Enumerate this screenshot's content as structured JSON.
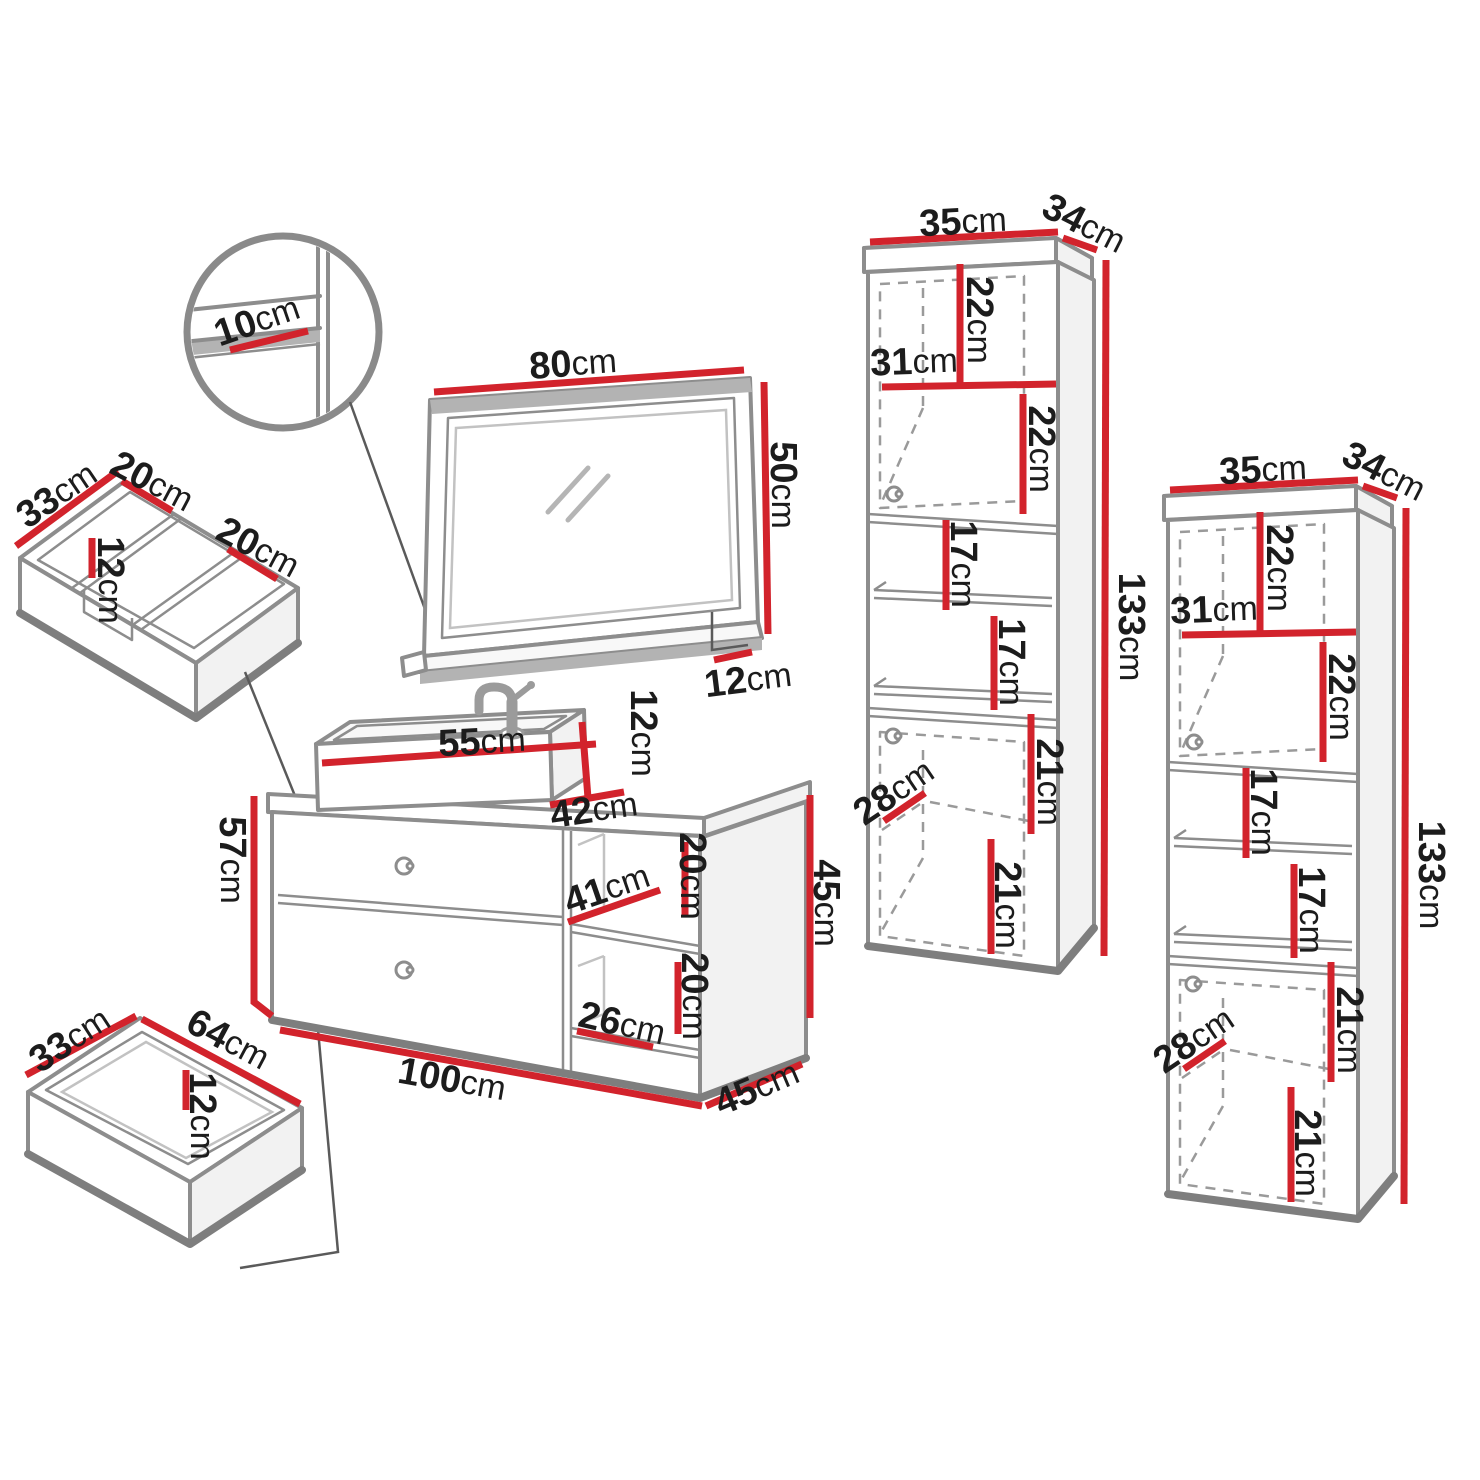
{
  "colors": {
    "red": "#d2232c",
    "gray": "#8d8d8d",
    "edge": "#7e7e7e",
    "dash": "#9a9a9a",
    "ink": "#1c1c1c",
    "bg": "#ffffff"
  },
  "detail_circle": {
    "shelf_depth": {
      "v": "10",
      "u": "cm"
    }
  },
  "mirror": {
    "width": {
      "v": "80",
      "u": "cm"
    },
    "height": {
      "v": "50",
      "u": "cm"
    },
    "shelf_depth": {
      "v": "12",
      "u": "cm"
    }
  },
  "organizer_insert": {
    "depth": {
      "v": "33",
      "u": "cm"
    },
    "left_width": {
      "v": "20",
      "u": "cm"
    },
    "height": {
      "v": "12",
      "u": "cm"
    },
    "right_width": {
      "v": "20",
      "u": "cm"
    }
  },
  "bottom_drawer": {
    "depth": {
      "v": "33",
      "u": "cm"
    },
    "width": {
      "v": "64",
      "u": "cm"
    },
    "height": {
      "v": "12",
      "u": "cm"
    }
  },
  "sink": {
    "width": {
      "v": "55",
      "u": "cm"
    },
    "height": {
      "v": "12",
      "u": "cm"
    },
    "depth": {
      "v": "42",
      "u": "cm"
    }
  },
  "vanity": {
    "height_left": {
      "v": "57",
      "u": "cm"
    },
    "width": {
      "v": "100",
      "u": "cm"
    },
    "depth": {
      "v": "45",
      "u": "cm"
    },
    "height_right": {
      "v": "45",
      "u": "cm"
    },
    "niche_top_height": {
      "v": "20",
      "u": "cm"
    },
    "niche_width": {
      "v": "41",
      "u": "cm"
    },
    "niche_bottom_height": {
      "v": "20",
      "u": "cm"
    },
    "niche_bottom_width": {
      "v": "26",
      "u": "cm"
    }
  },
  "cabinet_1": {
    "width": {
      "v": "35",
      "u": "cm"
    },
    "depth": {
      "v": "34",
      "u": "cm"
    },
    "height": {
      "v": "133",
      "u": "cm"
    },
    "top_section_height": {
      "v": "22",
      "u": "cm"
    },
    "shelf_width": {
      "v": "31",
      "u": "cm"
    },
    "second_section_height": {
      "v": "22",
      "u": "cm"
    },
    "mid_shelf_1_height": {
      "v": "17",
      "u": "cm"
    },
    "mid_shelf_2_height": {
      "v": "17",
      "u": "cm"
    },
    "lower_top_height": {
      "v": "21",
      "u": "cm"
    },
    "door_depth": {
      "v": "28",
      "u": "cm"
    },
    "lower_bottom_height": {
      "v": "21",
      "u": "cm"
    }
  },
  "cabinet_2": {
    "width": {
      "v": "35",
      "u": "cm"
    },
    "depth": {
      "v": "34",
      "u": "cm"
    },
    "height": {
      "v": "133",
      "u": "cm"
    },
    "top_section_height": {
      "v": "22",
      "u": "cm"
    },
    "shelf_width": {
      "v": "31",
      "u": "cm"
    },
    "second_section_height": {
      "v": "22",
      "u": "cm"
    },
    "mid_shelf_1_height": {
      "v": "17",
      "u": "cm"
    },
    "mid_shelf_2_height": {
      "v": "17",
      "u": "cm"
    },
    "lower_top_height": {
      "v": "21",
      "u": "cm"
    },
    "door_depth": {
      "v": "28",
      "u": "cm"
    },
    "lower_bottom_height": {
      "v": "21",
      "u": "cm"
    }
  }
}
